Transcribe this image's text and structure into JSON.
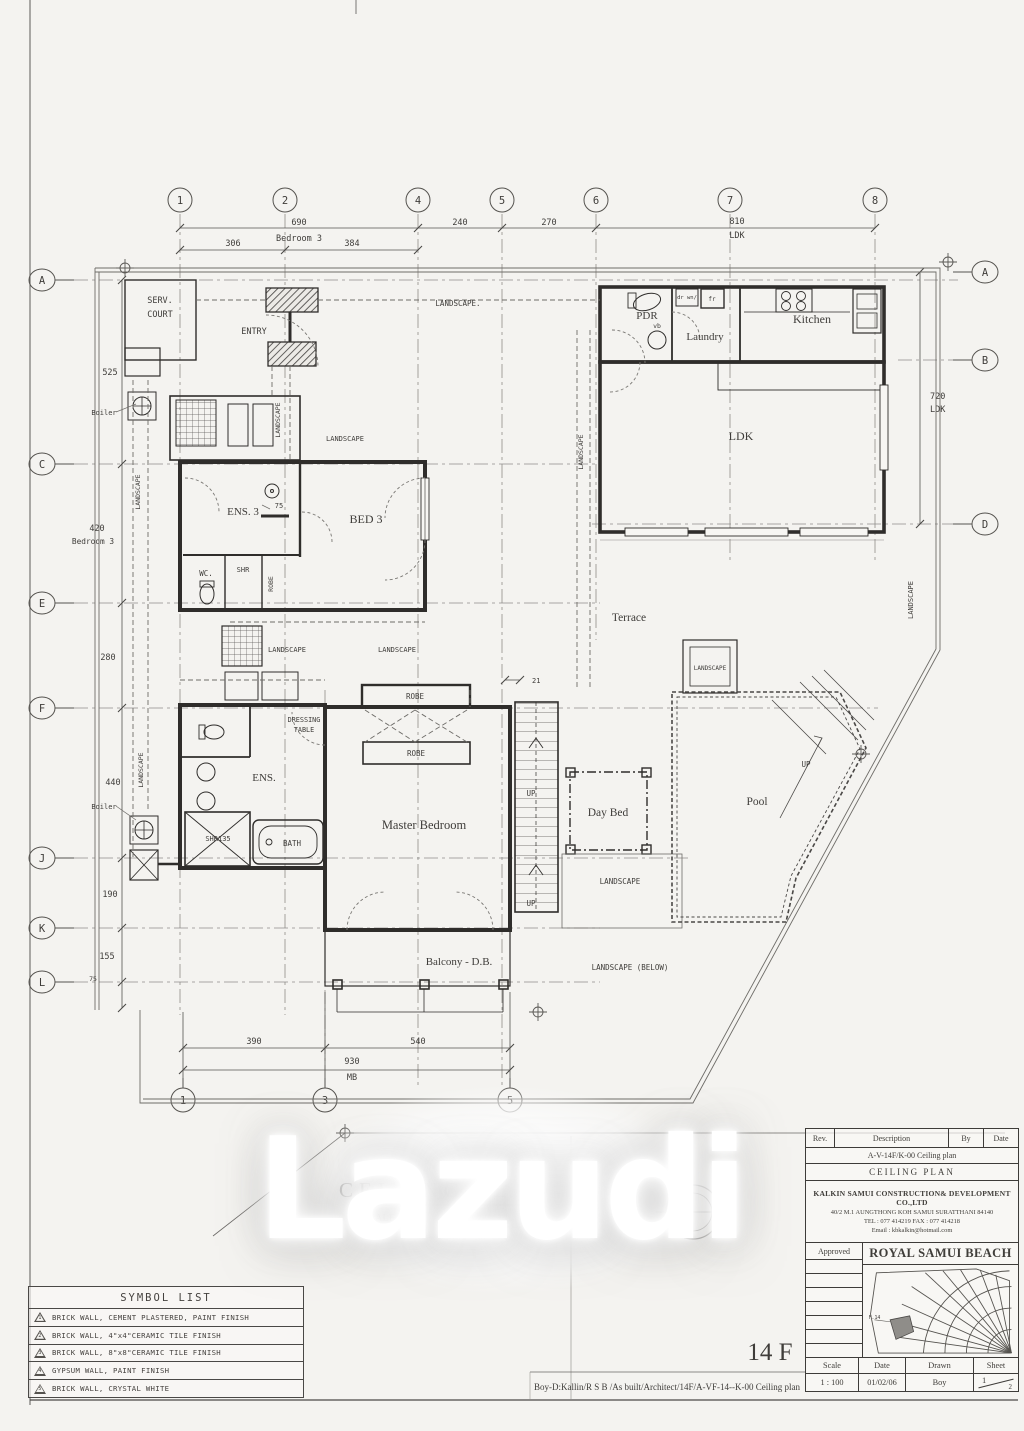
{
  "watermark": {
    "text": "Lazudi"
  },
  "sheet": {
    "title": "CEILING PLAN",
    "scale_label": "SCALE",
    "scale_value": "1:100",
    "floor_code": "14 F",
    "footer_path": "Boy-D:Kallin/R S B /As built/Architect/14F/A-VF-14--K-00 Ceiling plan"
  },
  "grid": {
    "top": [
      "1",
      "2",
      "4",
      "5",
      "6",
      "7",
      "8"
    ],
    "bottom": [
      "1",
      "3",
      "5"
    ],
    "left": [
      "A",
      "C",
      "E",
      "F",
      "J",
      "K",
      "L"
    ],
    "right": [
      "A",
      "B",
      "D"
    ]
  },
  "dims": {
    "top_690": "690",
    "top_room": "Bedroom 3",
    "d306": "306",
    "d384": "384",
    "d240": "240",
    "d270": "270",
    "d810": "810",
    "ldk": "LDK",
    "left_525": "525",
    "left_420": "420",
    "left_room": "Bedroom 3",
    "left_280": "280",
    "left_440": "440",
    "left_190": "190",
    "left_155": "155",
    "left_75": "75",
    "right_720": "720",
    "bot_390": "390",
    "bot_540": "540",
    "bot_930": "930",
    "bot_mb": "MB",
    "d21": "21",
    "d75": "75"
  },
  "labels": {
    "serv1": "SERV.",
    "serv2": "COURT",
    "entry": "ENTRY",
    "landscape": "LANDSCAPE",
    "landscape_dot": "LANDSCAPE.",
    "landscape_below": "LANDSCAPE (BELOW)",
    "boiler": "Boiler",
    "pdr": "PDR",
    "vb": "vb",
    "drwn": "dr wn/",
    "fr": "fr",
    "laundry": "Laundry",
    "kitchen": "Kitchen",
    "ldk": "LDK",
    "ens3": "ENS. 3",
    "bed3": "BED 3",
    "wc": "WC.",
    "wc2": "WC",
    "shr": "SHR",
    "robe": "ROBE",
    "dressing1": "DRESSING",
    "dressing2": "TABLE",
    "master": "Master Bedroom",
    "ens": "ENS.",
    "shr135": "SHR135",
    "bath": "BATH",
    "terrace": "Terrace",
    "daybed": "Day Bed",
    "pool": "Pool",
    "up": "UP",
    "balcony": "Balcony - D.B."
  },
  "symbols": {
    "title": "SYMBOL LIST",
    "items": [
      {
        "num": "1",
        "label": "BRICK WALL, CEMENT PLASTERED, PAINT FINISH"
      },
      {
        "num": "2",
        "label": "BRICK WALL, 4\"x4\"CERAMIC TILE FINISH"
      },
      {
        "num": "3",
        "label": "BRICK WALL, 8\"x8\"CERAMIC TILE FINISH"
      },
      {
        "num": "4",
        "label": "GYPSUM WALL, PAINT FINISH"
      },
      {
        "num": "5",
        "label": "BRICK WALL, CRYSTAL WHITE"
      }
    ]
  },
  "titleblock": {
    "rev": "Rev.",
    "description": "Description",
    "by": "By",
    "date_h": "Date",
    "doc_code": "A-V-14F/K-00 Ceiling plan",
    "doc_title": "CEILING PLAN",
    "company": "KALKIN SAMUI CONSTRUCTION& DEVELOPMENT CO.,LTD",
    "address": "40/2 M.1 AUNGTHONG KOH SAMUI SURATTHANI 84140",
    "phones": "TEL : 077 414219   FAX : 077 414218",
    "email": "Email : kbkalkin@hotmail.com",
    "approved": "Approved",
    "project": "ROYAL SAMUI BEACH",
    "plot": "F.14",
    "scale_label": "Scale",
    "date_label": "Date",
    "drawn_label": "Drawn",
    "sheet_label": "Sheet",
    "scale": "1 : 100",
    "date": "01/02/06",
    "drawn": "Boy",
    "sheet_no": "1",
    "sheet_of": "2"
  }
}
